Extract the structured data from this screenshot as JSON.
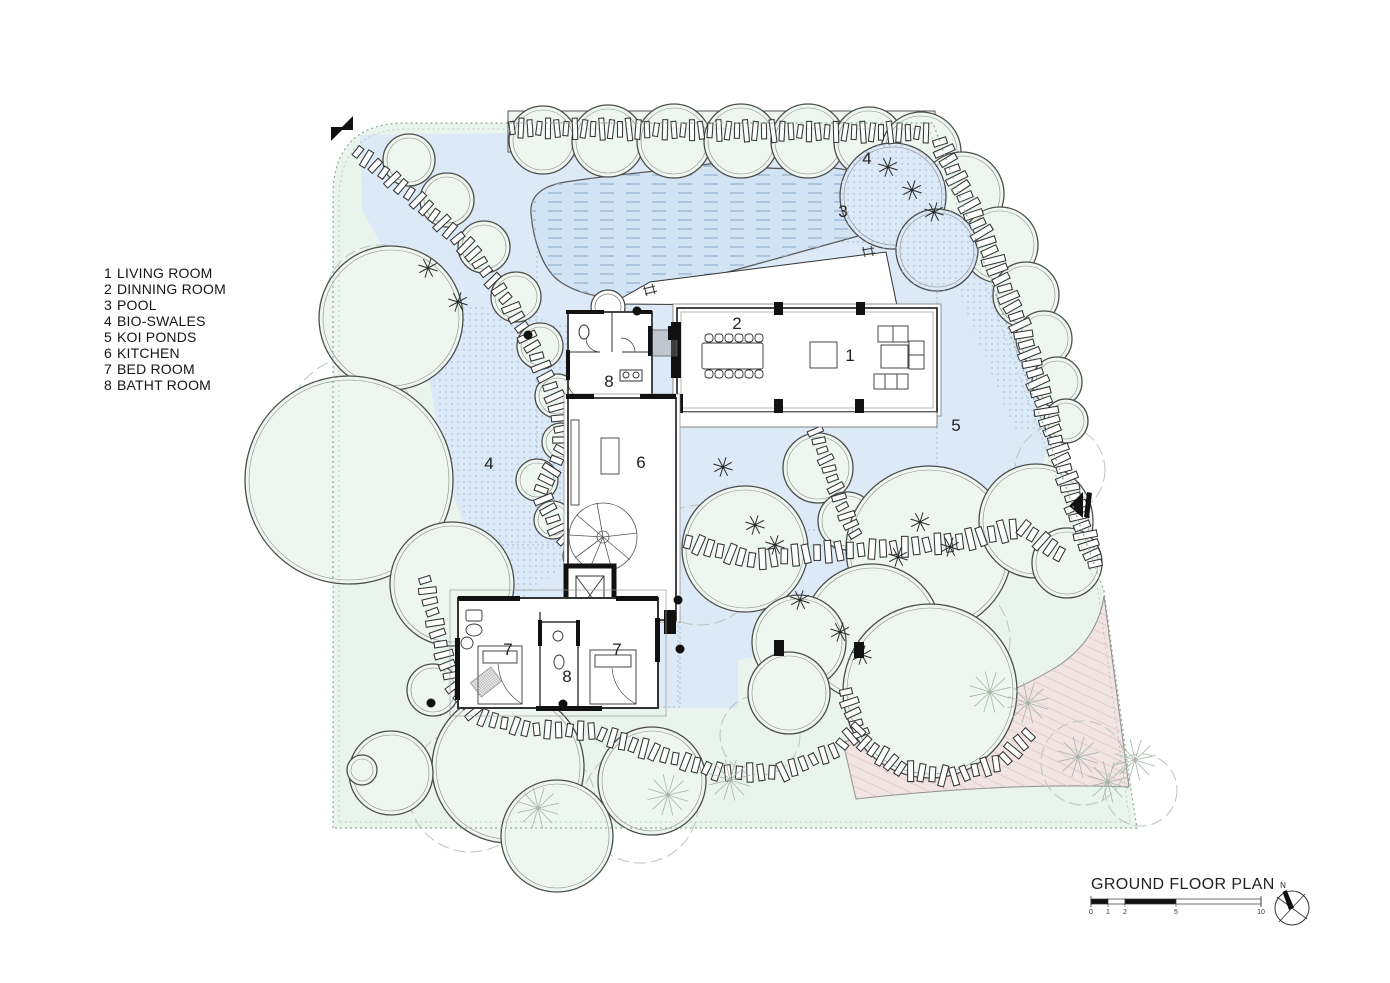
{
  "drawing": {
    "title": "GROUND FLOOR PLAN",
    "north_label": "N",
    "scale_bar": {
      "ticks": [
        0,
        1,
        2,
        5,
        10
      ],
      "unit_px": 17
    }
  },
  "legend": {
    "items": [
      {
        "num": "1",
        "label": "LIVING ROOM"
      },
      {
        "num": "2",
        "label": "DINNING ROOM"
      },
      {
        "num": "3",
        "label": "POOL"
      },
      {
        "num": "4",
        "label": "BIO-SWALES"
      },
      {
        "num": "5",
        "label": "KOI PONDS"
      },
      {
        "num": "6",
        "label": "KITCHEN"
      },
      {
        "num": "7",
        "label": "BED ROOM"
      },
      {
        "num": "8",
        "label": "BATHT ROOM"
      }
    ]
  },
  "plan": {
    "room_labels": [
      {
        "text": "3",
        "x": 843,
        "y": 217
      },
      {
        "text": "4",
        "x": 867,
        "y": 164
      },
      {
        "text": "4",
        "x": 489,
        "y": 469
      },
      {
        "text": "5",
        "x": 956,
        "y": 431
      },
      {
        "text": "2",
        "x": 737,
        "y": 329
      },
      {
        "text": "1",
        "x": 850,
        "y": 361
      },
      {
        "text": "6",
        "x": 641,
        "y": 468
      },
      {
        "text": "8",
        "x": 609,
        "y": 387
      },
      {
        "text": "8",
        "x": 567,
        "y": 682
      },
      {
        "text": "7",
        "x": 508,
        "y": 655
      },
      {
        "text": "7",
        "x": 617,
        "y": 655
      }
    ],
    "trees": [
      [
        543,
        140,
        34
      ],
      [
        608,
        141,
        36
      ],
      [
        674,
        141,
        37
      ],
      [
        741,
        141,
        37
      ],
      [
        808,
        141,
        37
      ],
      [
        869,
        142,
        35
      ],
      [
        921,
        152,
        40
      ],
      [
        409,
        160,
        26
      ],
      [
        447,
        200,
        27
      ],
      [
        484,
        247,
        26
      ],
      [
        516,
        297,
        25
      ],
      [
        540,
        346,
        23
      ],
      [
        557,
        396,
        22
      ],
      [
        561,
        442,
        19
      ],
      [
        537,
        480,
        21
      ],
      [
        553,
        520,
        19
      ],
      [
        580,
        556,
        17
      ],
      [
        391,
        318,
        72
      ],
      [
        349,
        480,
        104
      ],
      [
        452,
        584,
        62
      ],
      [
        433,
        690,
        26
      ],
      [
        508,
        767,
        76
      ],
      [
        391,
        773,
        42
      ],
      [
        362,
        770,
        15
      ],
      [
        962,
        194,
        42
      ],
      [
        1000,
        245,
        38
      ],
      [
        1026,
        295,
        33
      ],
      [
        1044,
        339,
        28
      ],
      [
        1057,
        382,
        25
      ],
      [
        1066,
        421,
        22
      ],
      [
        893,
        196,
        53,
        "dotted"
      ],
      [
        937,
        250,
        41,
        "dotted"
      ],
      [
        745,
        549,
        63
      ],
      [
        818,
        468,
        35
      ],
      [
        847,
        521,
        29
      ],
      [
        929,
        549,
        83
      ],
      [
        1036,
        521,
        57
      ],
      [
        1067,
        563,
        35
      ],
      [
        872,
        633,
        69
      ],
      [
        930,
        691,
        87
      ],
      [
        799,
        642,
        47
      ],
      [
        789,
        693,
        41
      ],
      [
        652,
        781,
        54
      ],
      [
        557,
        836,
        56
      ]
    ],
    "light_canopies": [
      [
        380,
        300,
        55
      ],
      [
        352,
        420,
        62
      ],
      [
        470,
        790,
        62
      ],
      [
        640,
        805,
        58
      ],
      [
        545,
        800,
        50
      ],
      [
        700,
        565,
        60
      ],
      [
        815,
        600,
        55
      ],
      [
        950,
        640,
        60
      ],
      [
        1083,
        763,
        42
      ],
      [
        1141,
        790,
        36
      ],
      [
        900,
        160,
        40
      ],
      [
        1060,
        470,
        45
      ],
      [
        760,
        735,
        40
      ]
    ],
    "stars_dark": [
      [
        428,
        268
      ],
      [
        458,
        302
      ],
      [
        723,
        467
      ],
      [
        888,
        167
      ],
      [
        912,
        190
      ],
      [
        934,
        212
      ],
      [
        920,
        522
      ],
      [
        950,
        547
      ],
      [
        898,
        557
      ],
      [
        840,
        632
      ],
      [
        862,
        655
      ],
      [
        800,
        600
      ],
      [
        755,
        525
      ],
      [
        775,
        545
      ]
    ],
    "stars_light": [
      [
        1078,
        757
      ],
      [
        1108,
        782
      ],
      [
        1135,
        760
      ],
      [
        668,
        795
      ],
      [
        730,
        780
      ],
      [
        990,
        692
      ],
      [
        1028,
        703
      ],
      [
        538,
        808
      ]
    ],
    "stone_paths": [
      {
        "pts": [
          [
            512,
            128
          ],
          [
            930,
            133
          ]
        ],
        "gap": 9,
        "len": 18,
        "w": 5
      },
      {
        "pts": [
          [
            358,
            152
          ],
          [
            420,
            202
          ],
          [
            472,
            252
          ],
          [
            508,
            302
          ],
          [
            533,
            348
          ],
          [
            556,
            400
          ],
          [
            563,
            448
          ],
          [
            540,
            492
          ],
          [
            558,
            530
          ],
          [
            585,
            562
          ]
        ],
        "gap": 11,
        "len": 16,
        "w": 6
      },
      {
        "pts": [
          [
            940,
            142
          ],
          [
            985,
            240
          ],
          [
            1022,
            330
          ],
          [
            1052,
            430
          ],
          [
            1080,
            520
          ],
          [
            1098,
            572
          ]
        ],
        "gap": 10,
        "len": 19,
        "w": 6.5
      },
      {
        "pts": [
          [
            688,
            542
          ],
          [
            752,
            560
          ],
          [
            822,
            552
          ],
          [
            892,
            548
          ],
          [
            958,
            542
          ],
          [
            1022,
            527
          ],
          [
            1062,
            556
          ]
        ],
        "gap": 11,
        "len": 18,
        "w": 6.5
      },
      {
        "pts": [
          [
            846,
            692
          ],
          [
            862,
            742
          ],
          [
            902,
            770
          ],
          [
            952,
            777
          ],
          [
            1002,
            762
          ],
          [
            1032,
            731
          ]
        ],
        "gap": 11,
        "len": 17,
        "w": 6
      },
      {
        "pts": [
          [
            425,
            580
          ],
          [
            437,
            632
          ],
          [
            452,
            682
          ],
          [
            477,
            716
          ],
          [
            527,
            729
          ],
          [
            592,
            731
          ],
          [
            657,
            753
          ],
          [
            722,
            773
          ],
          [
            782,
            772
          ],
          [
            836,
            750
          ],
          [
            866,
            722
          ]
        ],
        "gap": 11,
        "len": 16,
        "w": 6
      },
      {
        "pts": [
          [
            812,
            422
          ],
          [
            828,
            466
          ],
          [
            842,
            506
          ],
          [
            858,
            540
          ]
        ],
        "gap": 10,
        "len": 14,
        "w": 5.5
      }
    ],
    "ref_dots": [
      [
        528,
        335
      ],
      [
        637,
        311
      ],
      [
        431,
        703
      ],
      [
        563,
        704
      ],
      [
        678,
        600
      ],
      [
        680,
        649
      ]
    ],
    "ref_squares": [
      [
        779,
        648
      ],
      [
        859,
        650
      ]
    ],
    "colors": {
      "landscape": "#e9f4ed",
      "tree": "#edf7f0",
      "tree_stroke": "#4d4d4d",
      "water": "#dce9f6",
      "pool": "#d2e3f3",
      "pool_dash": "#9db7d4",
      "swale_dot": "#a9c2de",
      "drive": "#f2e4e3",
      "drive_hatch": "#d9c0bf",
      "line": "#333333",
      "boundary": "#92a79a",
      "canopy": "#b9c7bd",
      "label": "#1f1f1f"
    }
  }
}
